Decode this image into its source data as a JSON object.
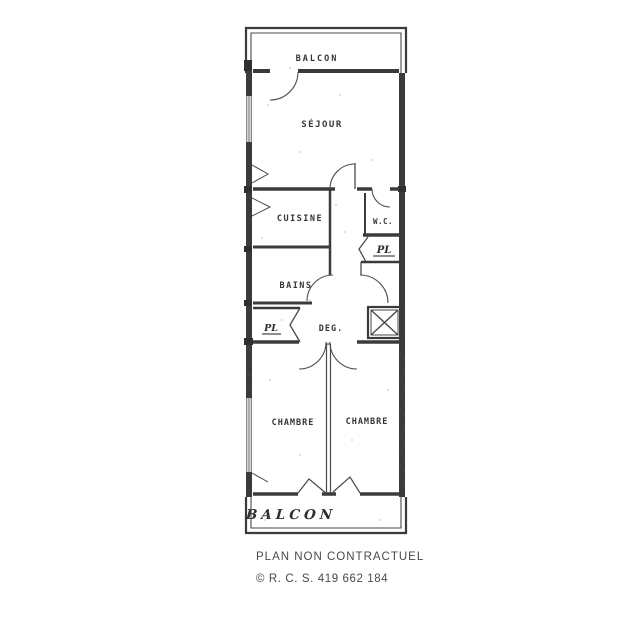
{
  "colors": {
    "background": "#ffffff",
    "plan_line": "#3b3b3b",
    "label_text": "#353535",
    "footer_text": "#4a4a4a"
  },
  "plan": {
    "rooms": {
      "balcon_top": "BALCON",
      "sejour": "SÉJOUR",
      "cuisine": "CUISINE",
      "wc": "W.C.",
      "pl_right": "PL",
      "bains": "BAINS",
      "pl_left": "PL",
      "deg": "DEG.",
      "chambre_left": "CHAMBRE",
      "chambre_right": "CHAMBRE",
      "balcon_bottom": "BALCON"
    }
  },
  "footer": {
    "line1": "PLAN NON CONTRACTUEL",
    "line2": "© R. C. S. 419 662 184"
  }
}
